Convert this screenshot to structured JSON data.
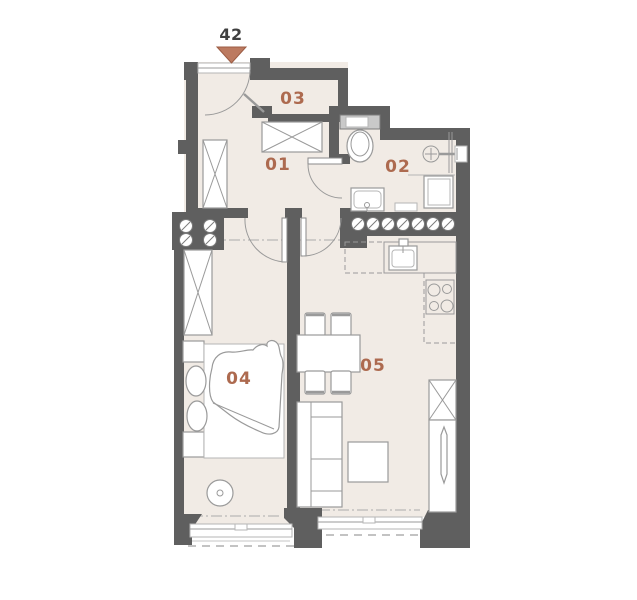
{
  "unit_marker": {
    "number": "42"
  },
  "rooms": [
    {
      "label": "01",
      "fixtures": [
        "entrance-door",
        "wardrobe",
        "built-in-closet"
      ]
    },
    {
      "label": "02",
      "fixtures": [
        "toilet",
        "washbasin",
        "shower",
        "washing-machine"
      ]
    },
    {
      "label": "03",
      "fixtures": [
        "storage-closet"
      ]
    },
    {
      "label": "04",
      "fixtures": [
        "double-bed",
        "pillows",
        "nightstands",
        "wardrobe",
        "stool"
      ]
    },
    {
      "label": "05",
      "fixtures": [
        "kitchen-counter",
        "kitchen-sink",
        "cooktop",
        "dining-table",
        "chairs",
        "sofa",
        "coffee-table",
        "wardrobe",
        "radiator"
      ]
    }
  ],
  "colors": {
    "wall": "#5f5f5f",
    "floor": "#f1ebe5",
    "accent": "#ad6a4f",
    "line": "#9a9a9a",
    "marker_triangle": "#bc7a60",
    "unit_text": "#3f3f3f"
  }
}
